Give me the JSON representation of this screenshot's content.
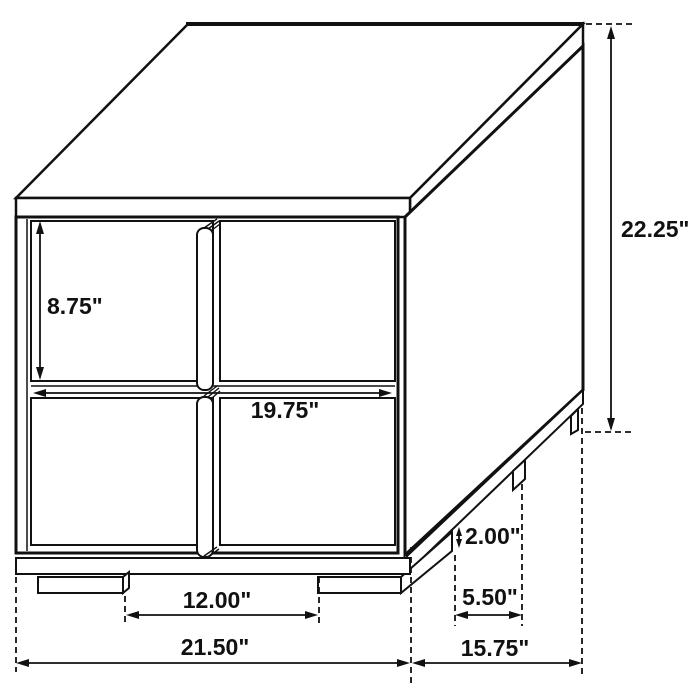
{
  "diagram": {
    "type": "furniture-dimension-drawing",
    "subject": "Two-drawer nightstand, isometric technical line drawing with dimension callouts",
    "background_color": "#ffffff",
    "line_color": "#111111",
    "dimensions": {
      "drawer_front_height": "8.75\"",
      "drawer_front_width": "19.75\"",
      "overall_height": "22.25\"",
      "front_leg_spacing": "12.00\"",
      "overall_width": "21.50\"",
      "overall_depth": "15.75\"",
      "side_leg_spacing": "5.50\"",
      "leg_height": "2.00\""
    }
  }
}
